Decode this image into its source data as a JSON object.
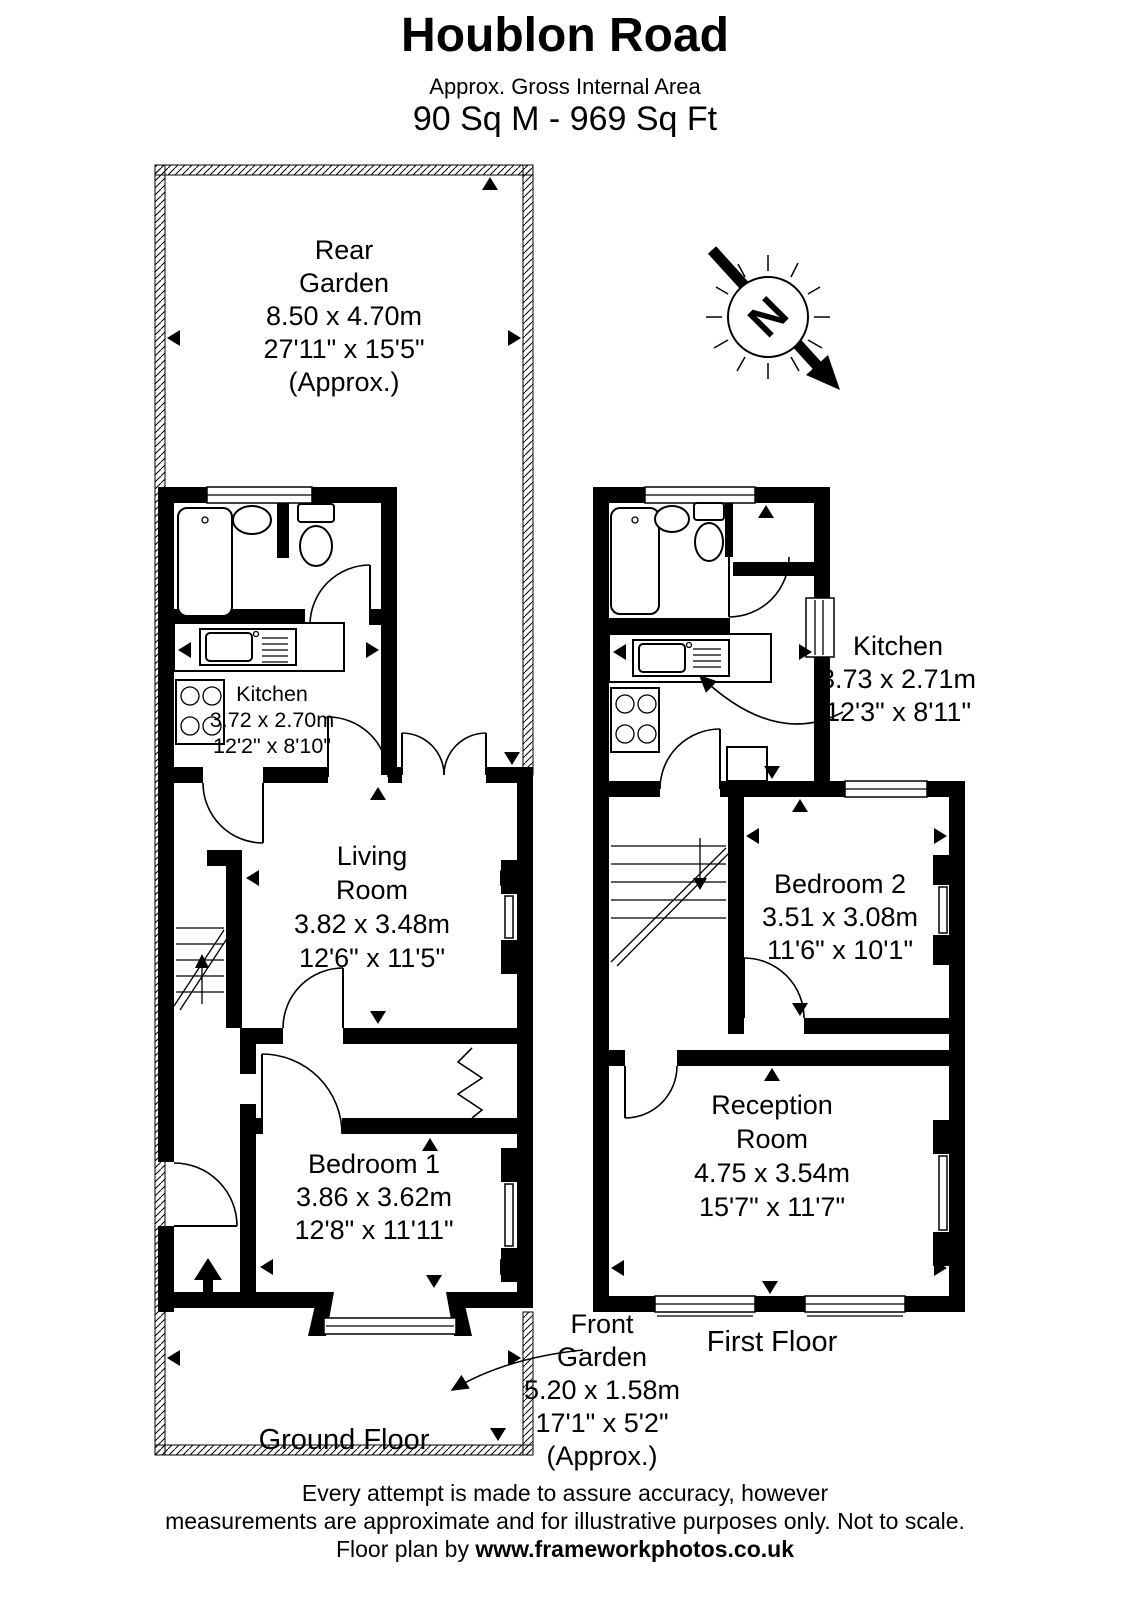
{
  "header": {
    "title": "Houblon Road",
    "subtitle": "Approx. Gross Internal Area",
    "area": "90 Sq M - 969 Sq Ft"
  },
  "compass": {
    "letter": "N"
  },
  "ground_floor": {
    "floor_label": "Ground Floor",
    "rear_garden": {
      "line1": "Rear",
      "line2": "Garden",
      "metric": "8.50 x 4.70m",
      "imperial": "27'11\" x 15'5\"",
      "approx": "(Approx.)"
    },
    "kitchen": {
      "name": "Kitchen",
      "metric": "3.72 x 2.70m",
      "imperial": "12'2\" x 8'10\""
    },
    "living_room": {
      "line1": "Living",
      "line2": "Room",
      "metric": "3.82 x 3.48m",
      "imperial": "12'6\" x 11'5\""
    },
    "bedroom_1": {
      "name": "Bedroom 1",
      "metric": "3.86 x 3.62m",
      "imperial": "12'8\" x 11'11\""
    },
    "front_garden": {
      "line1": "Front",
      "line2": "Garden",
      "metric": "5.20 x 1.58m",
      "imperial": "17'1\" x 5'2\"",
      "approx": "(Approx.)"
    }
  },
  "first_floor": {
    "floor_label": "First Floor",
    "kitchen": {
      "name": "Kitchen",
      "metric": "3.73 x 2.71m",
      "imperial": "12'3\" x 8'11\""
    },
    "bedroom_2": {
      "name": "Bedroom 2",
      "metric": "3.51 x 3.08m",
      "imperial": "11'6\" x 10'1\""
    },
    "reception_room": {
      "line1": "Reception",
      "line2": "Room",
      "metric": "4.75 x 3.54m",
      "imperial": "15'7\" x 11'7\""
    }
  },
  "footer": {
    "line1": "Every attempt is made to assure accuracy, however",
    "line2": "measurements are approximate and for illustrative purposes only. Not to scale.",
    "credit_prefix": "Floor plan by ",
    "credit_url": "www.frameworkphotos.co.uk"
  },
  "colors": {
    "wall": "#000000",
    "background": "#ffffff"
  }
}
